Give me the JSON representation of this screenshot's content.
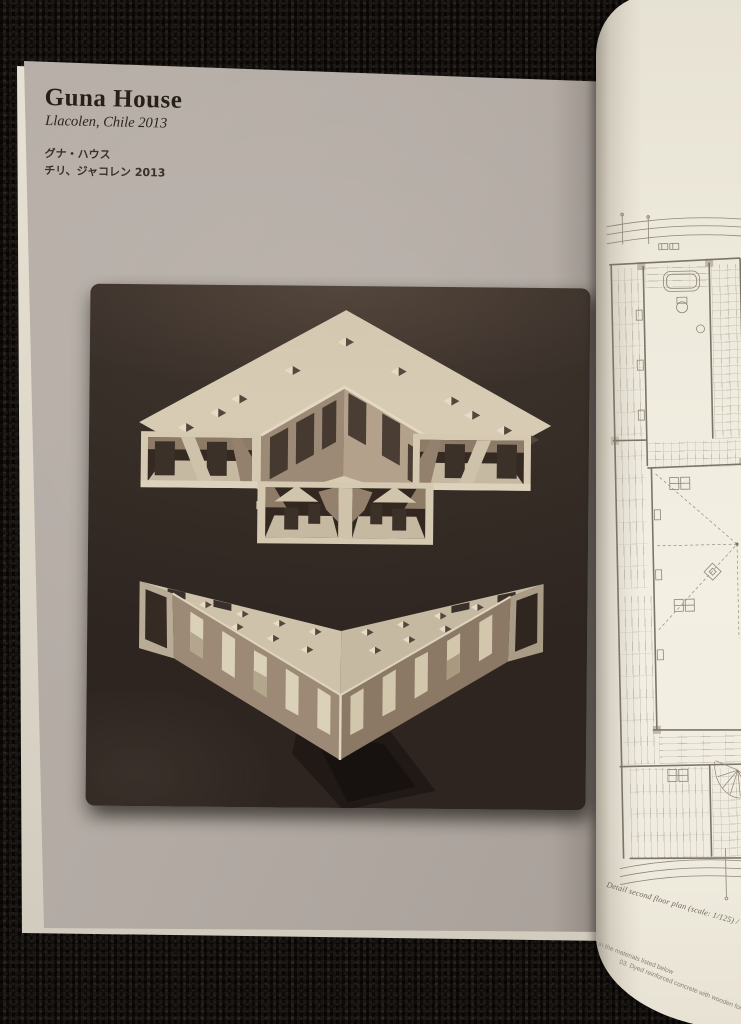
{
  "page_left": {
    "title": "Guna House",
    "subtitle": "Llacolen, Chile  2013",
    "title_japanese": "グナ・ハウス",
    "subtitle_japanese": "チリ、ジャコレン 2013"
  },
  "page_right": {
    "caption": "Detail second floor plan (scale: 1/125) /",
    "margin_note_line1": "in the materials listed below",
    "margin_note_line2": "03. Dyed reinforced concrete with wooden formwork"
  },
  "colors": {
    "carpet": "#14100d",
    "page_gray": "#b2aaa3",
    "page_cream": "#f0ecdf",
    "canvas_dark": "#382e29",
    "paint_cream": "#d7cbb4",
    "paint_tan": "#9d8a76",
    "plan_line": "#8e8678",
    "title_ink": "#281f18"
  }
}
